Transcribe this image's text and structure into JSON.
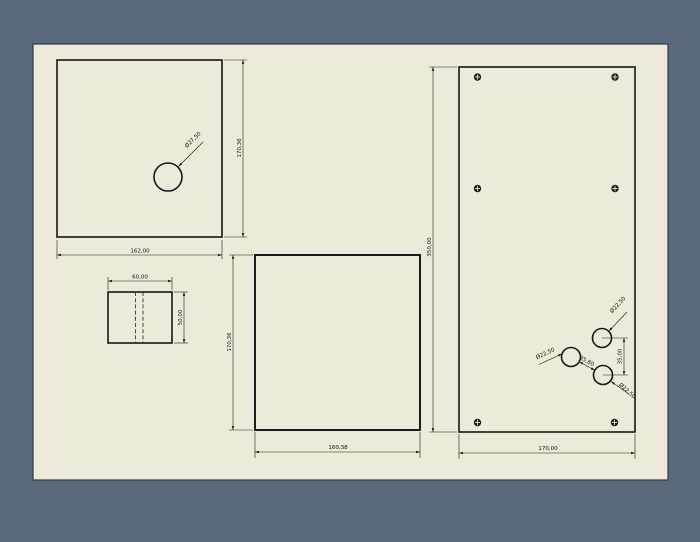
{
  "canvas": {
    "background_color": "#5a6a7e",
    "sheet_color": "#edeada",
    "line_color": "#1a1a1a"
  },
  "views": {
    "side_panel": {
      "width_dim": "162,00",
      "height_dim": "170,36",
      "hole_diameter": "Ø27,50"
    },
    "panel_edge": {
      "width_dim": "60,00",
      "height_dim": "50,00"
    },
    "back_panel": {
      "width_dim": "160,38",
      "height_dim": "170,36"
    },
    "front_panel": {
      "width_dim": "170,00",
      "height_dim": "350,00",
      "hole_top_diameter": "Ø22,50",
      "hole_left_diameter": "Ø22,50",
      "hole_bottom_diameter": "Ø22,50",
      "hole_vertical_spacing": "35,00",
      "hole_diagonal_spacing": "35,80"
    }
  }
}
